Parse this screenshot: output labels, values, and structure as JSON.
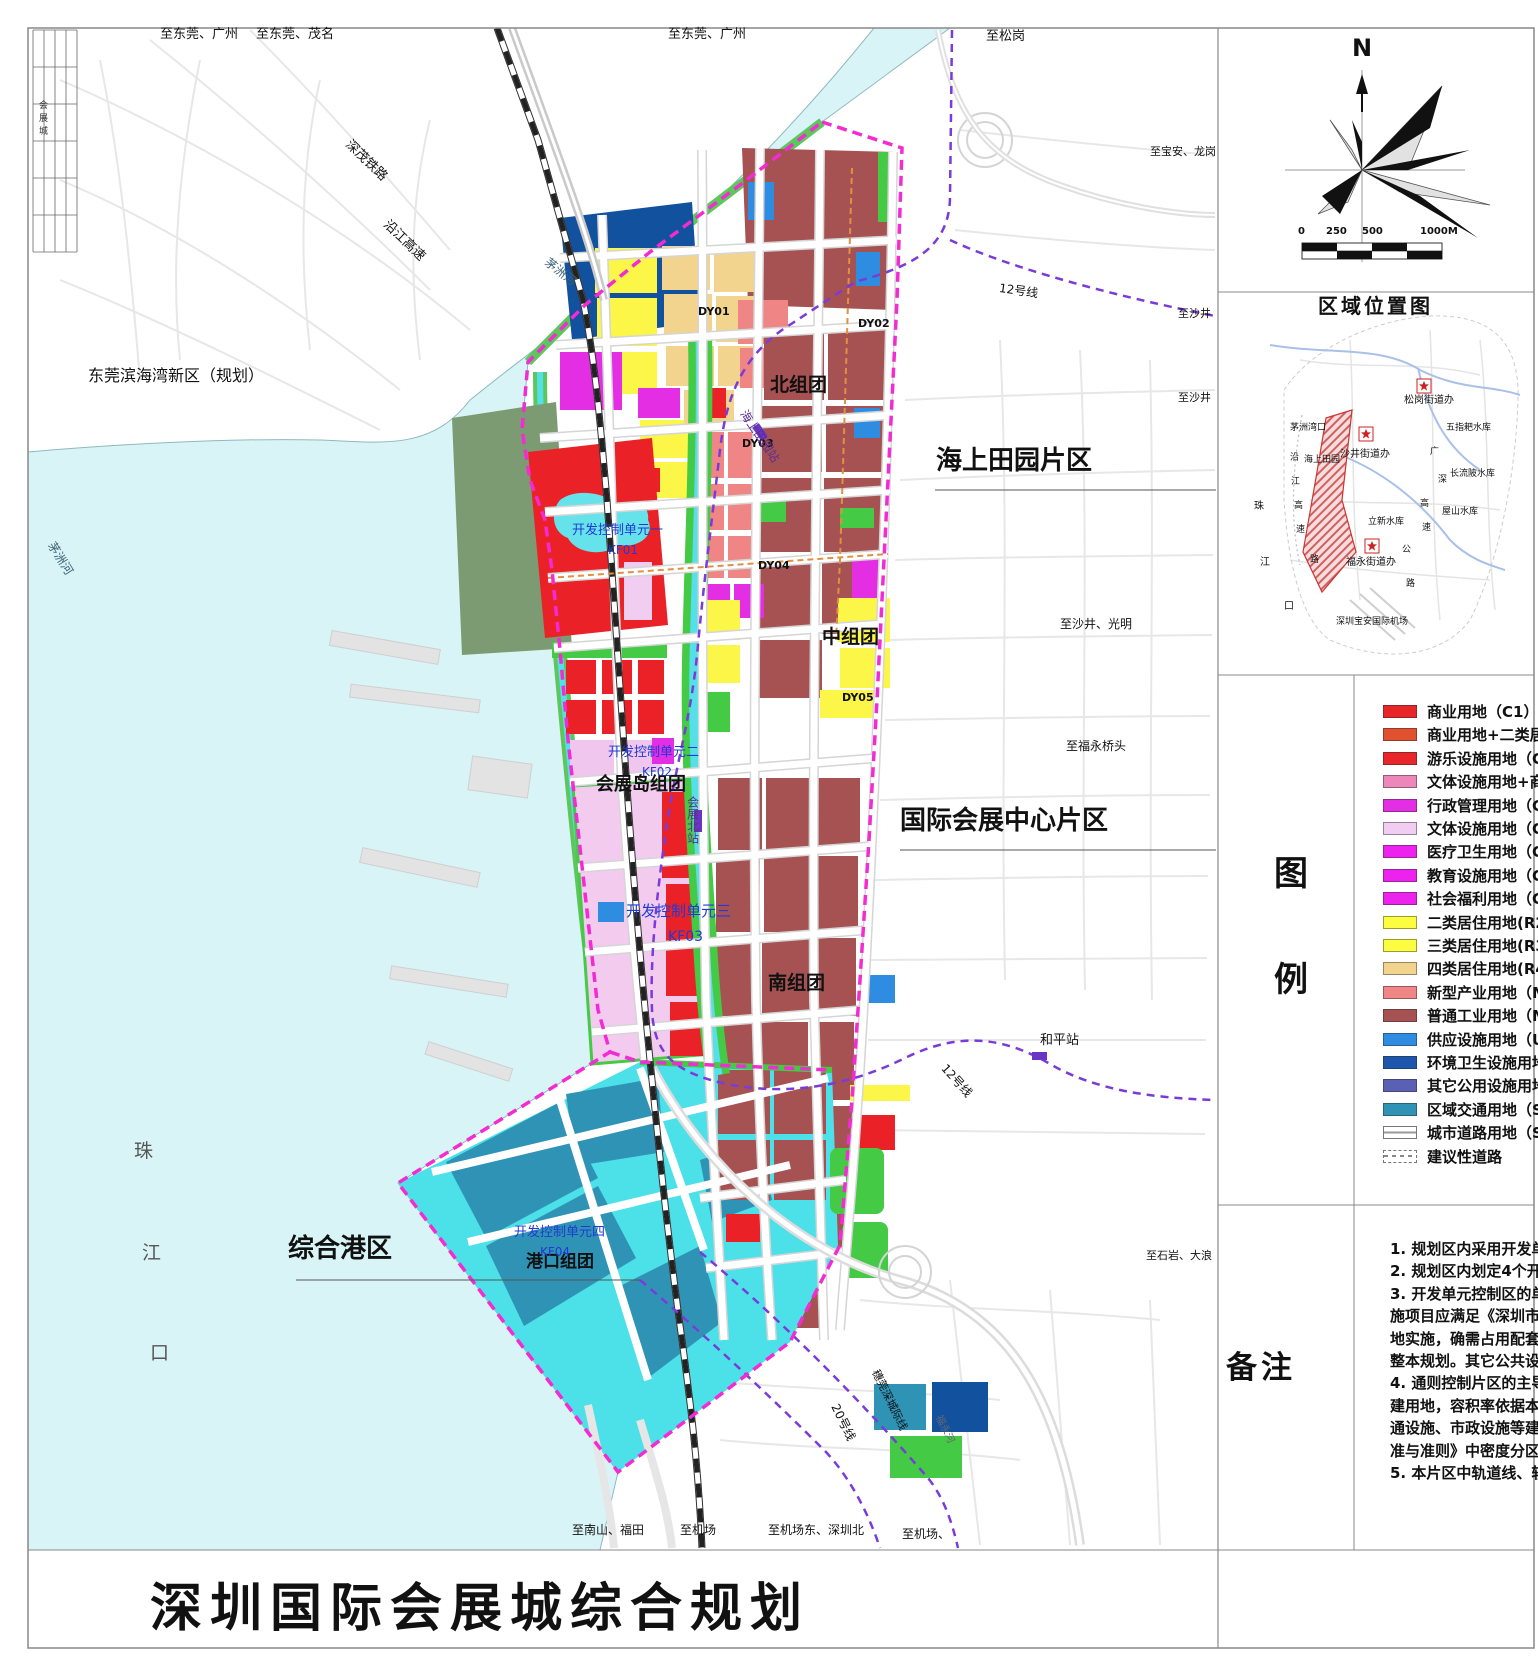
{
  "sheet": {
    "title": "深圳国际会展城综合规划",
    "corner_strip_text": "会展城"
  },
  "compass": {
    "north_label": "N"
  },
  "scale_bar": {
    "ticks": [
      "0",
      "250",
      "500",
      "1000M"
    ]
  },
  "location_map": {
    "title": "区域位置图",
    "labels": [
      {
        "t": "松岗街道办",
        "x": 1404,
        "y": 396,
        "s": 10
      },
      {
        "t": "五指耙水库",
        "x": 1446,
        "y": 424,
        "s": 9
      },
      {
        "t": "茅洲湾口",
        "x": 1290,
        "y": 424,
        "s": 9
      },
      {
        "t": "沙井街道办",
        "x": 1340,
        "y": 450,
        "s": 10
      },
      {
        "t": "海上田园",
        "x": 1304,
        "y": 456,
        "s": 9
      },
      {
        "t": "长流陂水库",
        "x": 1450,
        "y": 470,
        "s": 9
      },
      {
        "t": "广",
        "x": 1430,
        "y": 448,
        "s": 9
      },
      {
        "t": "深",
        "x": 1438,
        "y": 476,
        "s": 9
      },
      {
        "t": "沿",
        "x": 1290,
        "y": 454,
        "s": 9
      },
      {
        "t": "江",
        "x": 1291,
        "y": 478,
        "s": 9
      },
      {
        "t": "高",
        "x": 1294,
        "y": 502,
        "s": 9
      },
      {
        "t": "速",
        "x": 1296,
        "y": 526,
        "s": 9
      },
      {
        "t": "高",
        "x": 1420,
        "y": 500,
        "s": 9
      },
      {
        "t": "速",
        "x": 1422,
        "y": 524,
        "s": 9
      },
      {
        "t": "珠",
        "x": 1254,
        "y": 502,
        "s": 10
      },
      {
        "t": "江",
        "x": 1260,
        "y": 558,
        "s": 10
      },
      {
        "t": "口",
        "x": 1284,
        "y": 602,
        "s": 10
      },
      {
        "t": "屋山水库",
        "x": 1442,
        "y": 508,
        "s": 9
      },
      {
        "t": "立新水库",
        "x": 1368,
        "y": 518,
        "s": 9
      },
      {
        "t": "福永街道办",
        "x": 1346,
        "y": 558,
        "s": 10
      },
      {
        "t": "公",
        "x": 1402,
        "y": 546,
        "s": 9
      },
      {
        "t": "路",
        "x": 1406,
        "y": 580,
        "s": 9
      },
      {
        "t": "路",
        "x": 1310,
        "y": 556,
        "s": 9
      },
      {
        "t": "深圳宝安国际机场",
        "x": 1336,
        "y": 618,
        "s": 9
      }
    ]
  },
  "legend": {
    "row_label_top": "图",
    "row_label_bottom": "例",
    "items": [
      {
        "label": "商业用地（C1）",
        "type": "swatch",
        "color": "#e8262a"
      },
      {
        "label": "商业用地+二类居住用地",
        "type": "swatch",
        "color": "#e1512e"
      },
      {
        "label": "游乐设施用地（C5）",
        "type": "swatch",
        "color": "#e8262a"
      },
      {
        "label": "文体设施用地+商业用地",
        "type": "swatch",
        "color": "#ed87b9"
      },
      {
        "label": "行政管理用地（GIC1）",
        "type": "swatch",
        "color": "#e32ee3"
      },
      {
        "label": "文体设施用地（GIC2）",
        "type": "swatch",
        "color": "#f2cdf2"
      },
      {
        "label": "医疗卫生用地（GIC4）",
        "type": "swatch",
        "color": "#ee22ee"
      },
      {
        "label": "教育设施用地（GIC5）",
        "type": "swatch",
        "color": "#ee22ee"
      },
      {
        "label": "社会福利用地（GIC6）",
        "type": "swatch",
        "color": "#ee22ee"
      },
      {
        "label": "二类居住用地(R2)",
        "type": "swatch",
        "color": "#fcfc40"
      },
      {
        "label": "三类居住用地(R3)",
        "type": "swatch",
        "color": "#fcfc40"
      },
      {
        "label": "四类居住用地(R4)",
        "type": "swatch",
        "color": "#f3d48f"
      },
      {
        "label": "新型产业用地（M0）",
        "type": "swatch",
        "color": "#ef8585"
      },
      {
        "label": "普通工业用地（M1）",
        "type": "swatch",
        "color": "#a65252"
      },
      {
        "label": "供应设施用地（U1）",
        "type": "swatch",
        "color": "#2e8de0"
      },
      {
        "label": "环境卫生设施用地",
        "type": "swatch",
        "color": "#1c57ad"
      },
      {
        "label": "其它公用设施用地",
        "type": "swatch",
        "color": "#5a61b5"
      },
      {
        "label": "区域交通用地（S1）",
        "type": "swatch",
        "color": "#2f93b5"
      },
      {
        "label": "城市道路用地（S2）",
        "type": "road",
        "color": "#ffffff"
      },
      {
        "label": "建议性道路",
        "type": "dashed",
        "color": "#ffffff"
      }
    ]
  },
  "notes": {
    "section_label": "备注",
    "lines": [
      "1. 规划区内采用开发单元",
      "2. 规划区内划定4个开发单",
      "3. 开发单元控制区的单",
      "施项目应满足《深圳市",
      "地实施，确需占用配套",
      "整本规划。其它公共设",
      "4. 通则控制片区的主导",
      "建用地，容积率依据本",
      "通设施、市政设施等建",
      "准与准则》中密度分区",
      "5. 本片区中轨道线、轨道"
    ]
  },
  "map": {
    "labels": [
      {
        "t": "至东莞、广州",
        "x": 160,
        "y": 28,
        "s": 13
      },
      {
        "t": "至东莞、茂名",
        "x": 256,
        "y": 28,
        "s": 13
      },
      {
        "t": "至东莞、广州",
        "x": 668,
        "y": 28,
        "s": 13
      },
      {
        "t": "至松岗",
        "x": 986,
        "y": 30,
        "s": 13
      },
      {
        "t": "至宝安、龙岗",
        "x": 1150,
        "y": 146,
        "s": 11
      },
      {
        "t": "至沙井",
        "x": 1178,
        "y": 308,
        "s": 11
      },
      {
        "t": "至沙井",
        "x": 1178,
        "y": 392,
        "s": 11
      },
      {
        "t": "至沙井、光明",
        "x": 1060,
        "y": 618,
        "s": 12
      },
      {
        "t": "至福永桥头",
        "x": 1066,
        "y": 740,
        "s": 12
      },
      {
        "t": "至石岩、大浪",
        "x": 1146,
        "y": 1250,
        "s": 11
      },
      {
        "t": "至南山、福田",
        "x": 572,
        "y": 1524,
        "s": 12
      },
      {
        "t": "至机场",
        "x": 680,
        "y": 1524,
        "s": 12
      },
      {
        "t": "至机场东、深圳北",
        "x": 768,
        "y": 1524,
        "s": 12
      },
      {
        "t": "至机场、",
        "x": 902,
        "y": 1528,
        "s": 12
      },
      {
        "t": "12号线",
        "x": 1000,
        "y": 282,
        "s": 12,
        "rot": 8,
        "name": "metro-line-12-label"
      },
      {
        "t": "12号线",
        "x": 948,
        "y": 1062,
        "s": 12,
        "rot": 48,
        "name": "metro-line-12-label"
      },
      {
        "t": "20号线",
        "x": 840,
        "y": 1402,
        "s": 12,
        "rot": 64,
        "name": "metro-line-20-label"
      },
      {
        "t": "穗莞深城际线",
        "x": 880,
        "y": 1368,
        "s": 11,
        "rot": 64,
        "name": "intercity-line-label"
      },
      {
        "t": "深茂铁路",
        "x": 352,
        "y": 138,
        "s": 13,
        "rot": 44,
        "name": "railway-label"
      },
      {
        "t": "沿江高速",
        "x": 390,
        "y": 218,
        "s": 13,
        "rot": 44,
        "name": "expressway-label"
      },
      {
        "t": "茅洲河",
        "x": 550,
        "y": 256,
        "s": 12,
        "rot": 38,
        "color": "#3d6277",
        "name": "river-label"
      },
      {
        "t": "茅洲河",
        "x": 56,
        "y": 540,
        "s": 12,
        "rot": 58,
        "color": "#3d6277",
        "name": "river-label"
      },
      {
        "t": "福永河",
        "x": 942,
        "y": 1414,
        "s": 10,
        "rot": 64,
        "color": "#667",
        "name": "river-label"
      },
      {
        "t": "东莞滨海湾新区（规划）",
        "x": 88,
        "y": 368,
        "s": 16
      },
      {
        "t": "海上田园片区",
        "x": 936,
        "y": 448,
        "s": 26,
        "b": 1,
        "name": "district-label"
      },
      {
        "t": "国际会展中心片区",
        "x": 900,
        "y": 808,
        "s": 26,
        "b": 1,
        "name": "district-label"
      },
      {
        "t": "综合港区",
        "x": 288,
        "y": 1236,
        "s": 26,
        "b": 1,
        "name": "district-label"
      },
      {
        "t": "北组团",
        "x": 770,
        "y": 376,
        "s": 19,
        "b": 1,
        "name": "cluster-label"
      },
      {
        "t": "中组团",
        "x": 822,
        "y": 628,
        "s": 19,
        "b": 1,
        "name": "cluster-label"
      },
      {
        "t": "南组团",
        "x": 768,
        "y": 974,
        "s": 19,
        "b": 1,
        "name": "cluster-label"
      },
      {
        "t": "会展岛组团",
        "x": 596,
        "y": 776,
        "s": 18,
        "b": 1,
        "name": "cluster-label"
      },
      {
        "t": "港口组团",
        "x": 526,
        "y": 1254,
        "s": 17,
        "b": 1,
        "name": "cluster-label"
      },
      {
        "t": "DY01",
        "x": 698,
        "y": 306,
        "s": 11,
        "b": 1,
        "name": "unit-label"
      },
      {
        "t": "DY02",
        "x": 858,
        "y": 318,
        "s": 11,
        "b": 1,
        "name": "unit-label"
      },
      {
        "t": "DY03",
        "x": 742,
        "y": 438,
        "s": 11,
        "b": 1,
        "name": "unit-label"
      },
      {
        "t": "DY04",
        "x": 758,
        "y": 560,
        "s": 11,
        "b": 1,
        "name": "unit-label"
      },
      {
        "t": "DY05",
        "x": 842,
        "y": 692,
        "s": 11,
        "b": 1,
        "name": "unit-label"
      },
      {
        "t": "开发控制单元一",
        "x": 572,
        "y": 524,
        "s": 13,
        "color": "#1f3bd4",
        "name": "control-unit-label"
      },
      {
        "t": "KF01",
        "x": 608,
        "y": 544,
        "s": 12,
        "color": "#1f3bd4",
        "name": "control-unit-label"
      },
      {
        "t": "开发控制单元二",
        "x": 608,
        "y": 746,
        "s": 13,
        "color": "#1f3bd4",
        "name": "control-unit-label"
      },
      {
        "t": "KF02",
        "x": 642,
        "y": 766,
        "s": 12,
        "color": "#1f3bd4",
        "name": "control-unit-label"
      },
      {
        "t": "开发控制单元三",
        "x": 626,
        "y": 904,
        "s": 15,
        "color": "#1f3bd4",
        "name": "control-unit-label"
      },
      {
        "t": "KF03",
        "x": 668,
        "y": 930,
        "s": 14,
        "color": "#1f3bd4",
        "name": "control-unit-label"
      },
      {
        "t": "开发控制单元四",
        "x": 514,
        "y": 1226,
        "s": 13,
        "color": "#1f3bd4",
        "name": "control-unit-label"
      },
      {
        "t": "KF04",
        "x": 540,
        "y": 1246,
        "s": 12,
        "color": "#1f3bd4",
        "name": "control-unit-label"
      },
      {
        "t": "海上田园站",
        "x": 748,
        "y": 408,
        "s": 12,
        "rot": 56,
        "color": "#5b2d91",
        "name": "station-label"
      },
      {
        "t": "会展北站",
        "x": 686,
        "y": 796,
        "s": 12,
        "vert": 1,
        "color": "#5b2d91",
        "name": "station-label"
      },
      {
        "t": "和平站",
        "x": 1040,
        "y": 1034,
        "s": 13,
        "name": "station-label"
      },
      {
        "t": "珠",
        "x": 134,
        "y": 1142,
        "s": 19,
        "color": "#555"
      },
      {
        "t": "江",
        "x": 142,
        "y": 1244,
        "s": 19,
        "color": "#555"
      },
      {
        "t": "口",
        "x": 150,
        "y": 1344,
        "s": 19,
        "color": "#555"
      }
    ]
  }
}
